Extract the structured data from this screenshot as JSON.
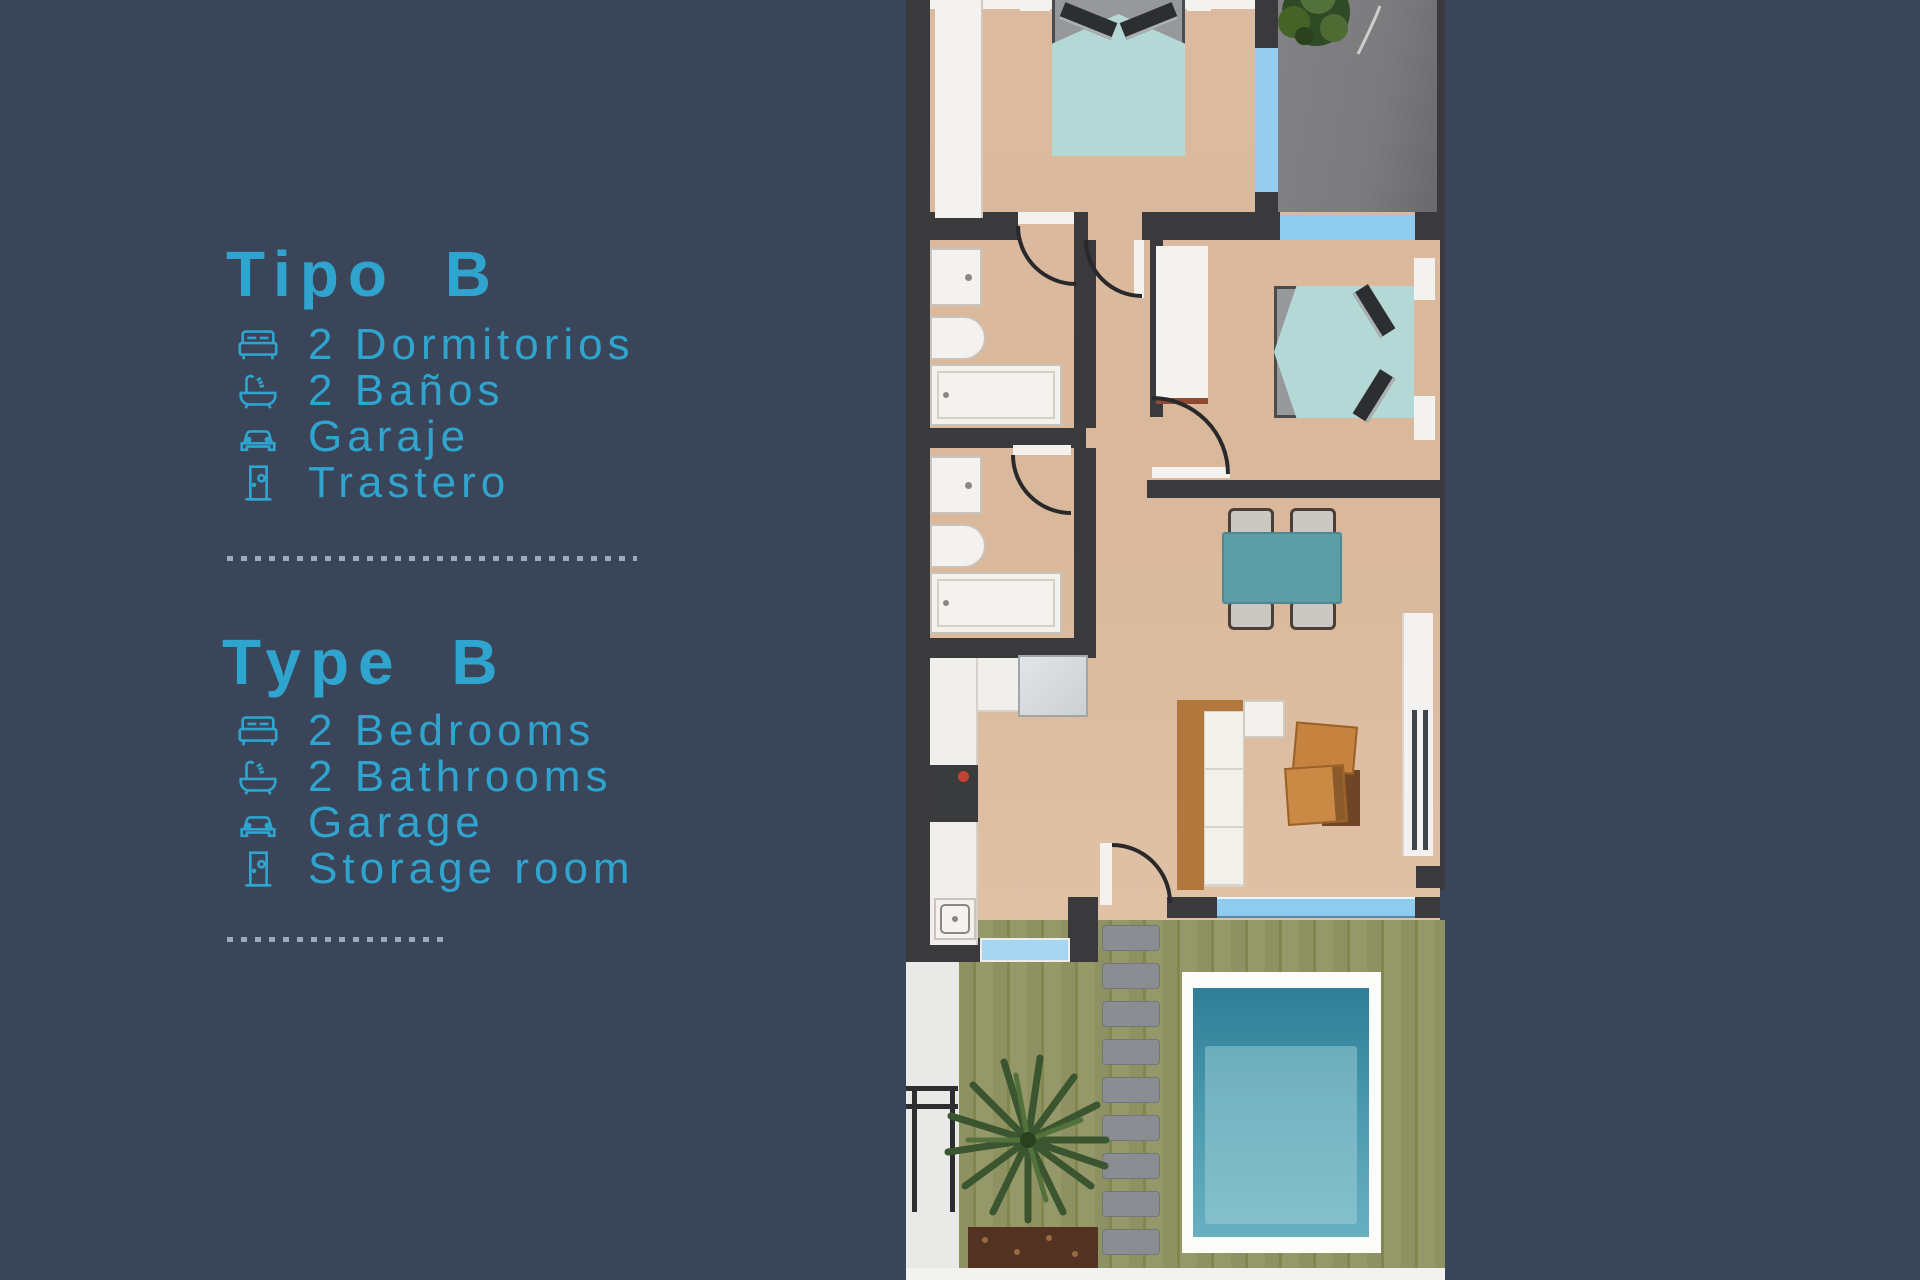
{
  "page": {
    "background_color": "#3B4559",
    "accent_color": "#2EA4CE",
    "divider_color": "#9AACB9"
  },
  "spanish_block": {
    "title": "Tipo B",
    "items": [
      {
        "icon": "bed-icon",
        "label": "2 Dormitorios"
      },
      {
        "icon": "bathtub-icon",
        "label": "2 Baños"
      },
      {
        "icon": "car-icon",
        "label": "Garaje"
      },
      {
        "icon": "door-icon",
        "label": "Trastero"
      }
    ]
  },
  "english_block": {
    "title": "Type B",
    "items": [
      {
        "icon": "bed-icon",
        "label": "2 Bedrooms"
      },
      {
        "icon": "bathtub-icon",
        "label": "2 Bathrooms"
      },
      {
        "icon": "car-icon",
        "label": "Garage"
      },
      {
        "icon": "door-icon",
        "label": "Storage room"
      }
    ]
  },
  "floorplan_palette": {
    "wall": "#3A393B",
    "floor_tan": "#DCBAA0",
    "window_blue": "#8FCBEE",
    "terrace_gray": "#7D7D80",
    "bed_cover_teal": "#B4D8D5",
    "dining_table_teal": "#5C9EA6",
    "garden_green": "#8E9262",
    "pool_water": "#2F7E97",
    "pool_deck": "#FBFBFA",
    "wood_furniture": "#C6833F"
  }
}
